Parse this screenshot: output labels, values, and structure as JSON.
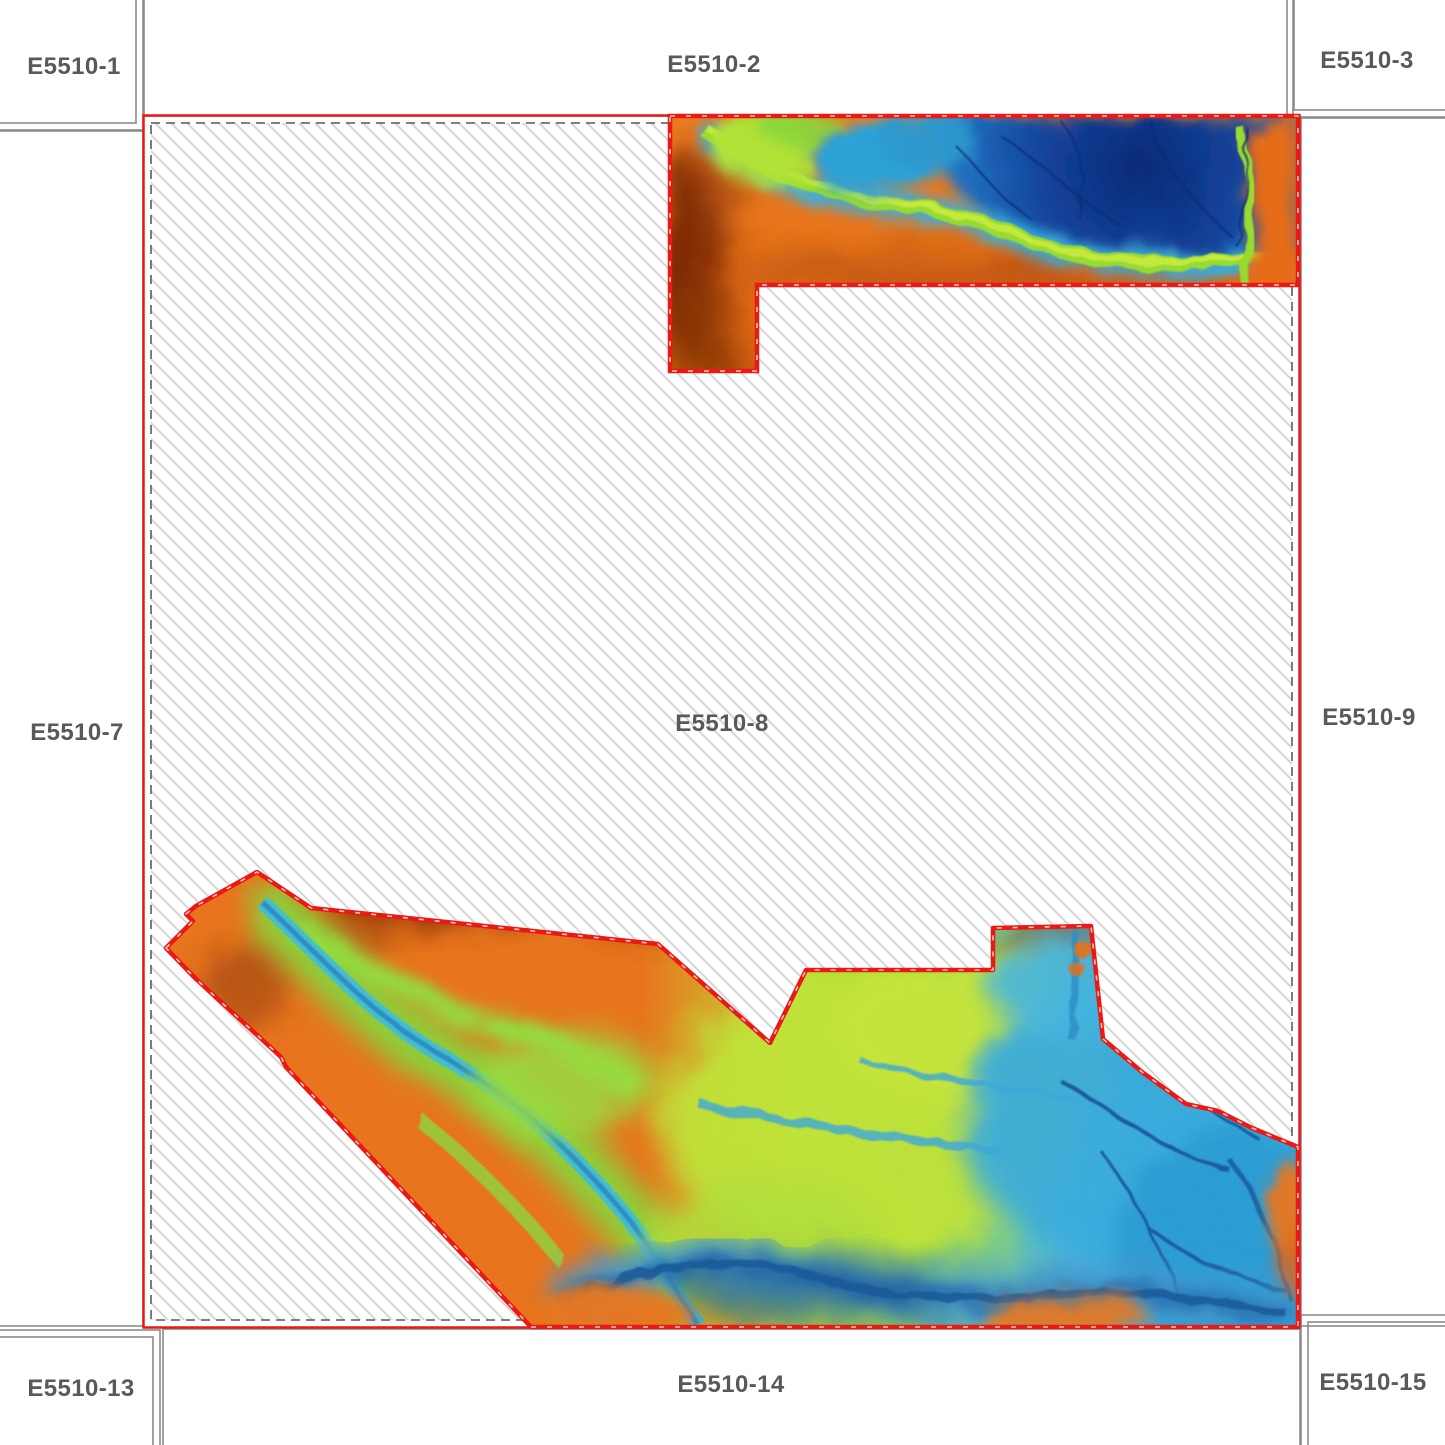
{
  "map": {
    "type": "sheet-index-with-dem-coverage",
    "center_sheet": "E5510-8"
  },
  "sheets": {
    "labels": [
      "E5510-1",
      "E5510-2",
      "E5510-3",
      "E5510-7",
      "E5510-8",
      "E5510-9",
      "E5510-13",
      "E5510-14",
      "E5510-15"
    ]
  },
  "colors": {
    "sheet_boundary_red": "#ec1813",
    "neighbor_border_gray": "#8a8a8a",
    "hatch_line_gray": "#d5d5d5",
    "dashed_outline_gray": "#6e6e6e",
    "label_text_gray": "#58595b",
    "dem_high_brown": "#7c2603",
    "dem_orange": "#f0781c",
    "dem_green_fringe": "#9ce32e",
    "dem_yellow_green": "#c6ea38",
    "dem_cyan": "#3db2e0",
    "dem_deep_blue": "#0c2b78"
  }
}
